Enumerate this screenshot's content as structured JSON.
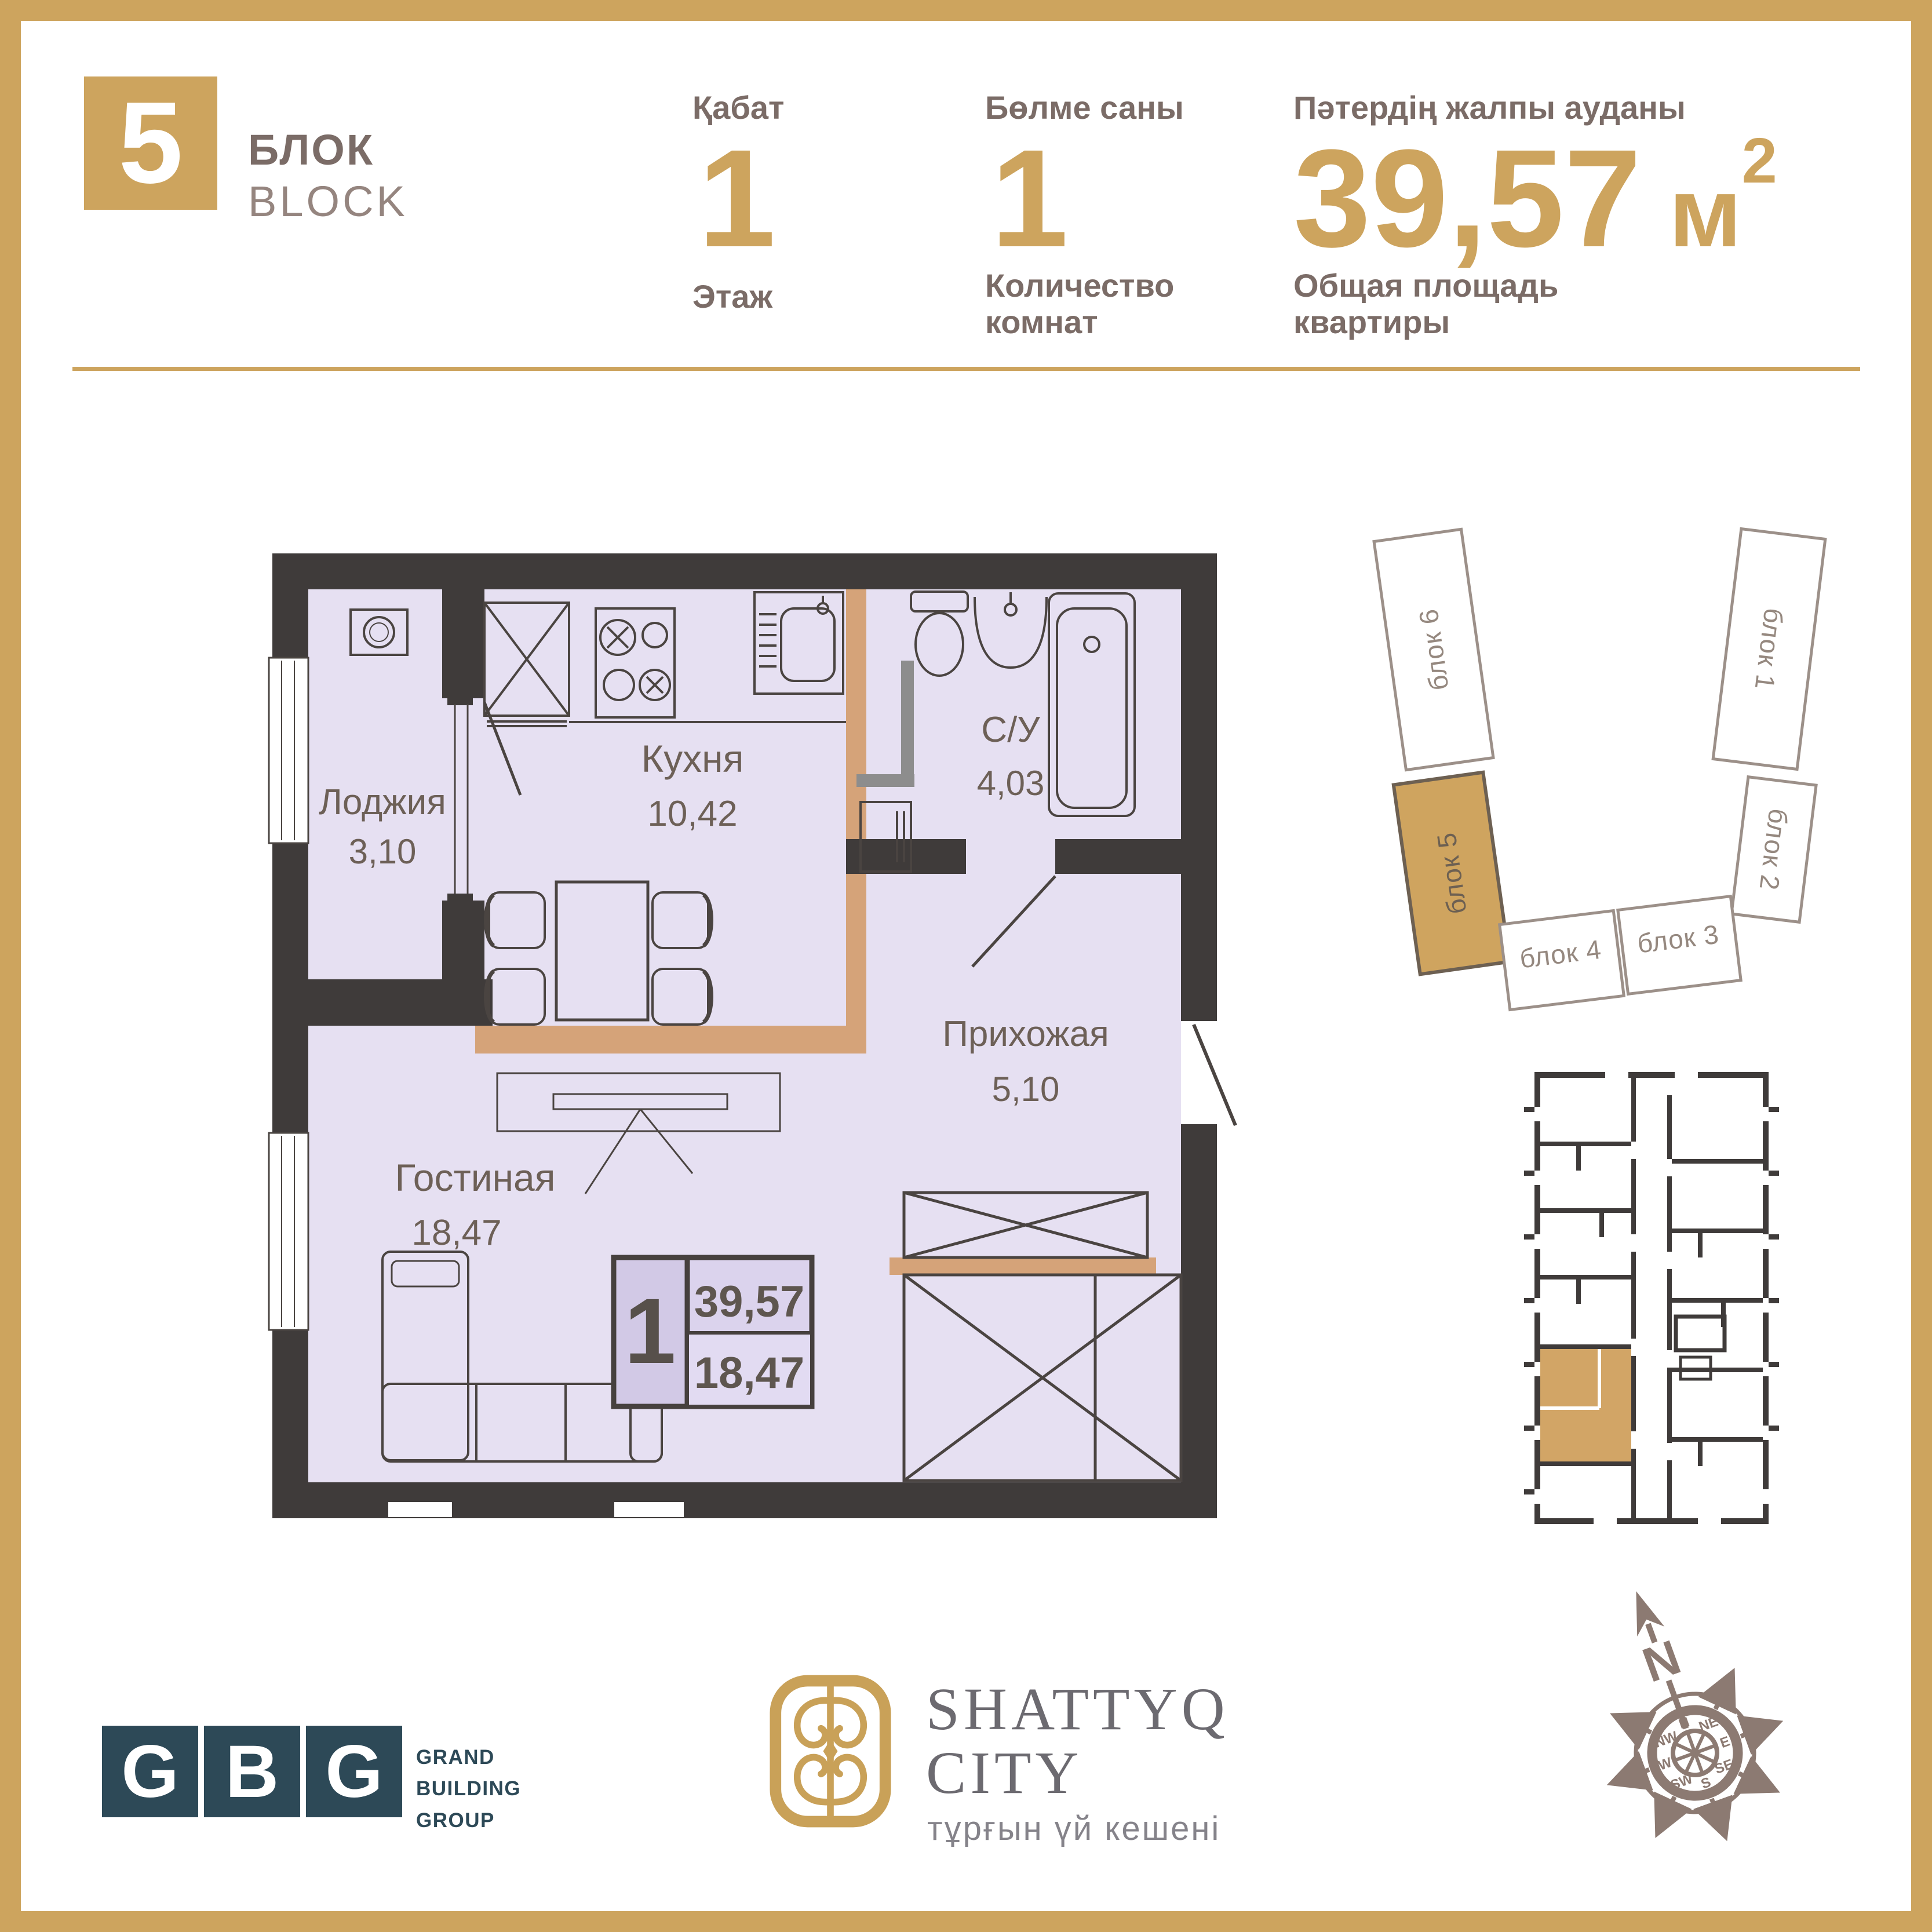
{
  "header": {
    "block_number": "5",
    "block_label_kz": "БЛОК",
    "block_label_en": "BLOCK",
    "floor_label_kz": "Қабат",
    "floor_value": "1",
    "floor_label_ru": "Этаж",
    "rooms_label_kz": "Бөлме саны",
    "rooms_value": "1",
    "rooms_label_ru1": "Количество",
    "rooms_label_ru2": "комнат",
    "area_label_kz": "Пәтердің жалпы ауданы",
    "area_value": "39,57",
    "area_unit": "м",
    "area_sup": "2",
    "area_label_ru1": "Общая площадь",
    "area_label_ru2": "квартиры"
  },
  "floorplan": {
    "rooms": [
      {
        "name": "Лоджия",
        "area": "3,10"
      },
      {
        "name": "Кухня",
        "area": "10,42"
      },
      {
        "name": "С/У",
        "area": "4,03"
      },
      {
        "name": "Прихожая",
        "area": "5,10"
      },
      {
        "name": "Гостиная",
        "area": "18,47"
      }
    ],
    "badge": {
      "rooms": "1",
      "total": "39,57",
      "living": "18,47"
    }
  },
  "siteplan": {
    "blocks": [
      {
        "label": "блок 6"
      },
      {
        "label": "блок 1"
      },
      {
        "label": "блок 5"
      },
      {
        "label": "блок 2"
      },
      {
        "label": "блок 4"
      },
      {
        "label": "блок 3"
      }
    ],
    "highlighted": "блок 5"
  },
  "compass": {
    "north": "N",
    "points": [
      "N",
      "NE",
      "E",
      "SE",
      "S",
      "SW",
      "W",
      "NW"
    ]
  },
  "logos": {
    "gbg": {
      "l1": "G",
      "l2": "B",
      "l3": "G",
      "c1": "GRAND",
      "c2": "BUILDING",
      "c3": "GROUP"
    },
    "shattyq": {
      "t1": "SHATTYQ",
      "t2": "CITY",
      "subtitle": "тұрғын үй кешені"
    }
  },
  "colors": {
    "gold": "#cda45e",
    "wall": "#3f3b3a",
    "floor": "#e6e0f2",
    "tan": "#d5a379",
    "gbg_teal": "#2d4957",
    "compass_brown": "#8c7a72"
  }
}
